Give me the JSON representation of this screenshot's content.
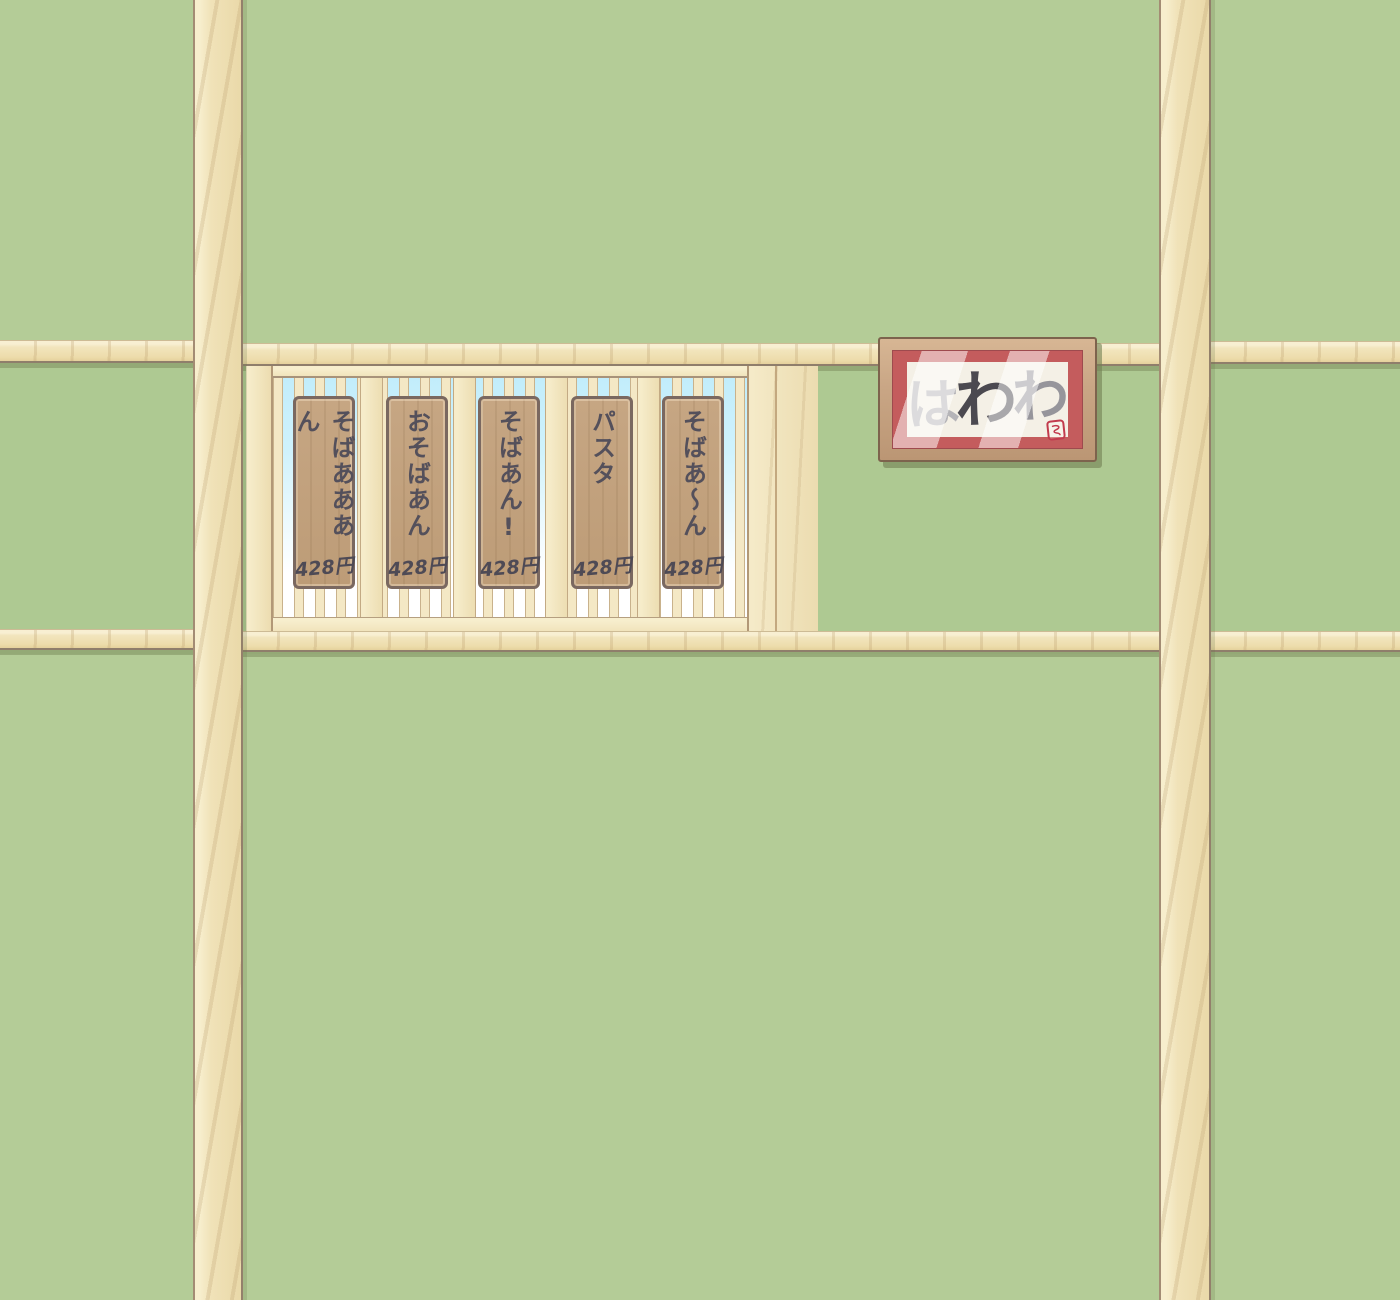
{
  "scene": {
    "description": "restaurant interior wall with wooden beams, a lattice menu window and a framed calligraphy picture",
    "palette": {
      "wall_green": "#b4cc97",
      "wall_green_mid": "#aec992",
      "beam_wood": "#f1e4bc",
      "beam_shadow_green": "#8f9e74",
      "sky_blue": "#c2edfb",
      "slat_cream": "#f4e8c5",
      "sign_wood": "#bfa07d",
      "sign_border": "#7a6860",
      "sign_text": "#54505b",
      "frame_wood": "#c9a685",
      "frame_mat_red": "#c45c5d",
      "paper_cream": "#f4f0e6",
      "seal_red": "#c23b4d"
    }
  },
  "menu_board": {
    "items": [
      {
        "label": "そばあああん",
        "price": "428円"
      },
      {
        "label": "おそばあん",
        "price": "428円"
      },
      {
        "label": "そばあん!",
        "price": "428円"
      },
      {
        "label": "パスタ",
        "price": "428円"
      },
      {
        "label": "そばあ〜ん",
        "price": "428円"
      }
    ]
  },
  "picture": {
    "calligraphy": "はわわ",
    "chars": [
      {
        "char": "は",
        "color": "#b5b4b8"
      },
      {
        "char": "わ",
        "color": "#4b4950"
      },
      {
        "char": "わ",
        "color": "#96959b"
      }
    ]
  }
}
